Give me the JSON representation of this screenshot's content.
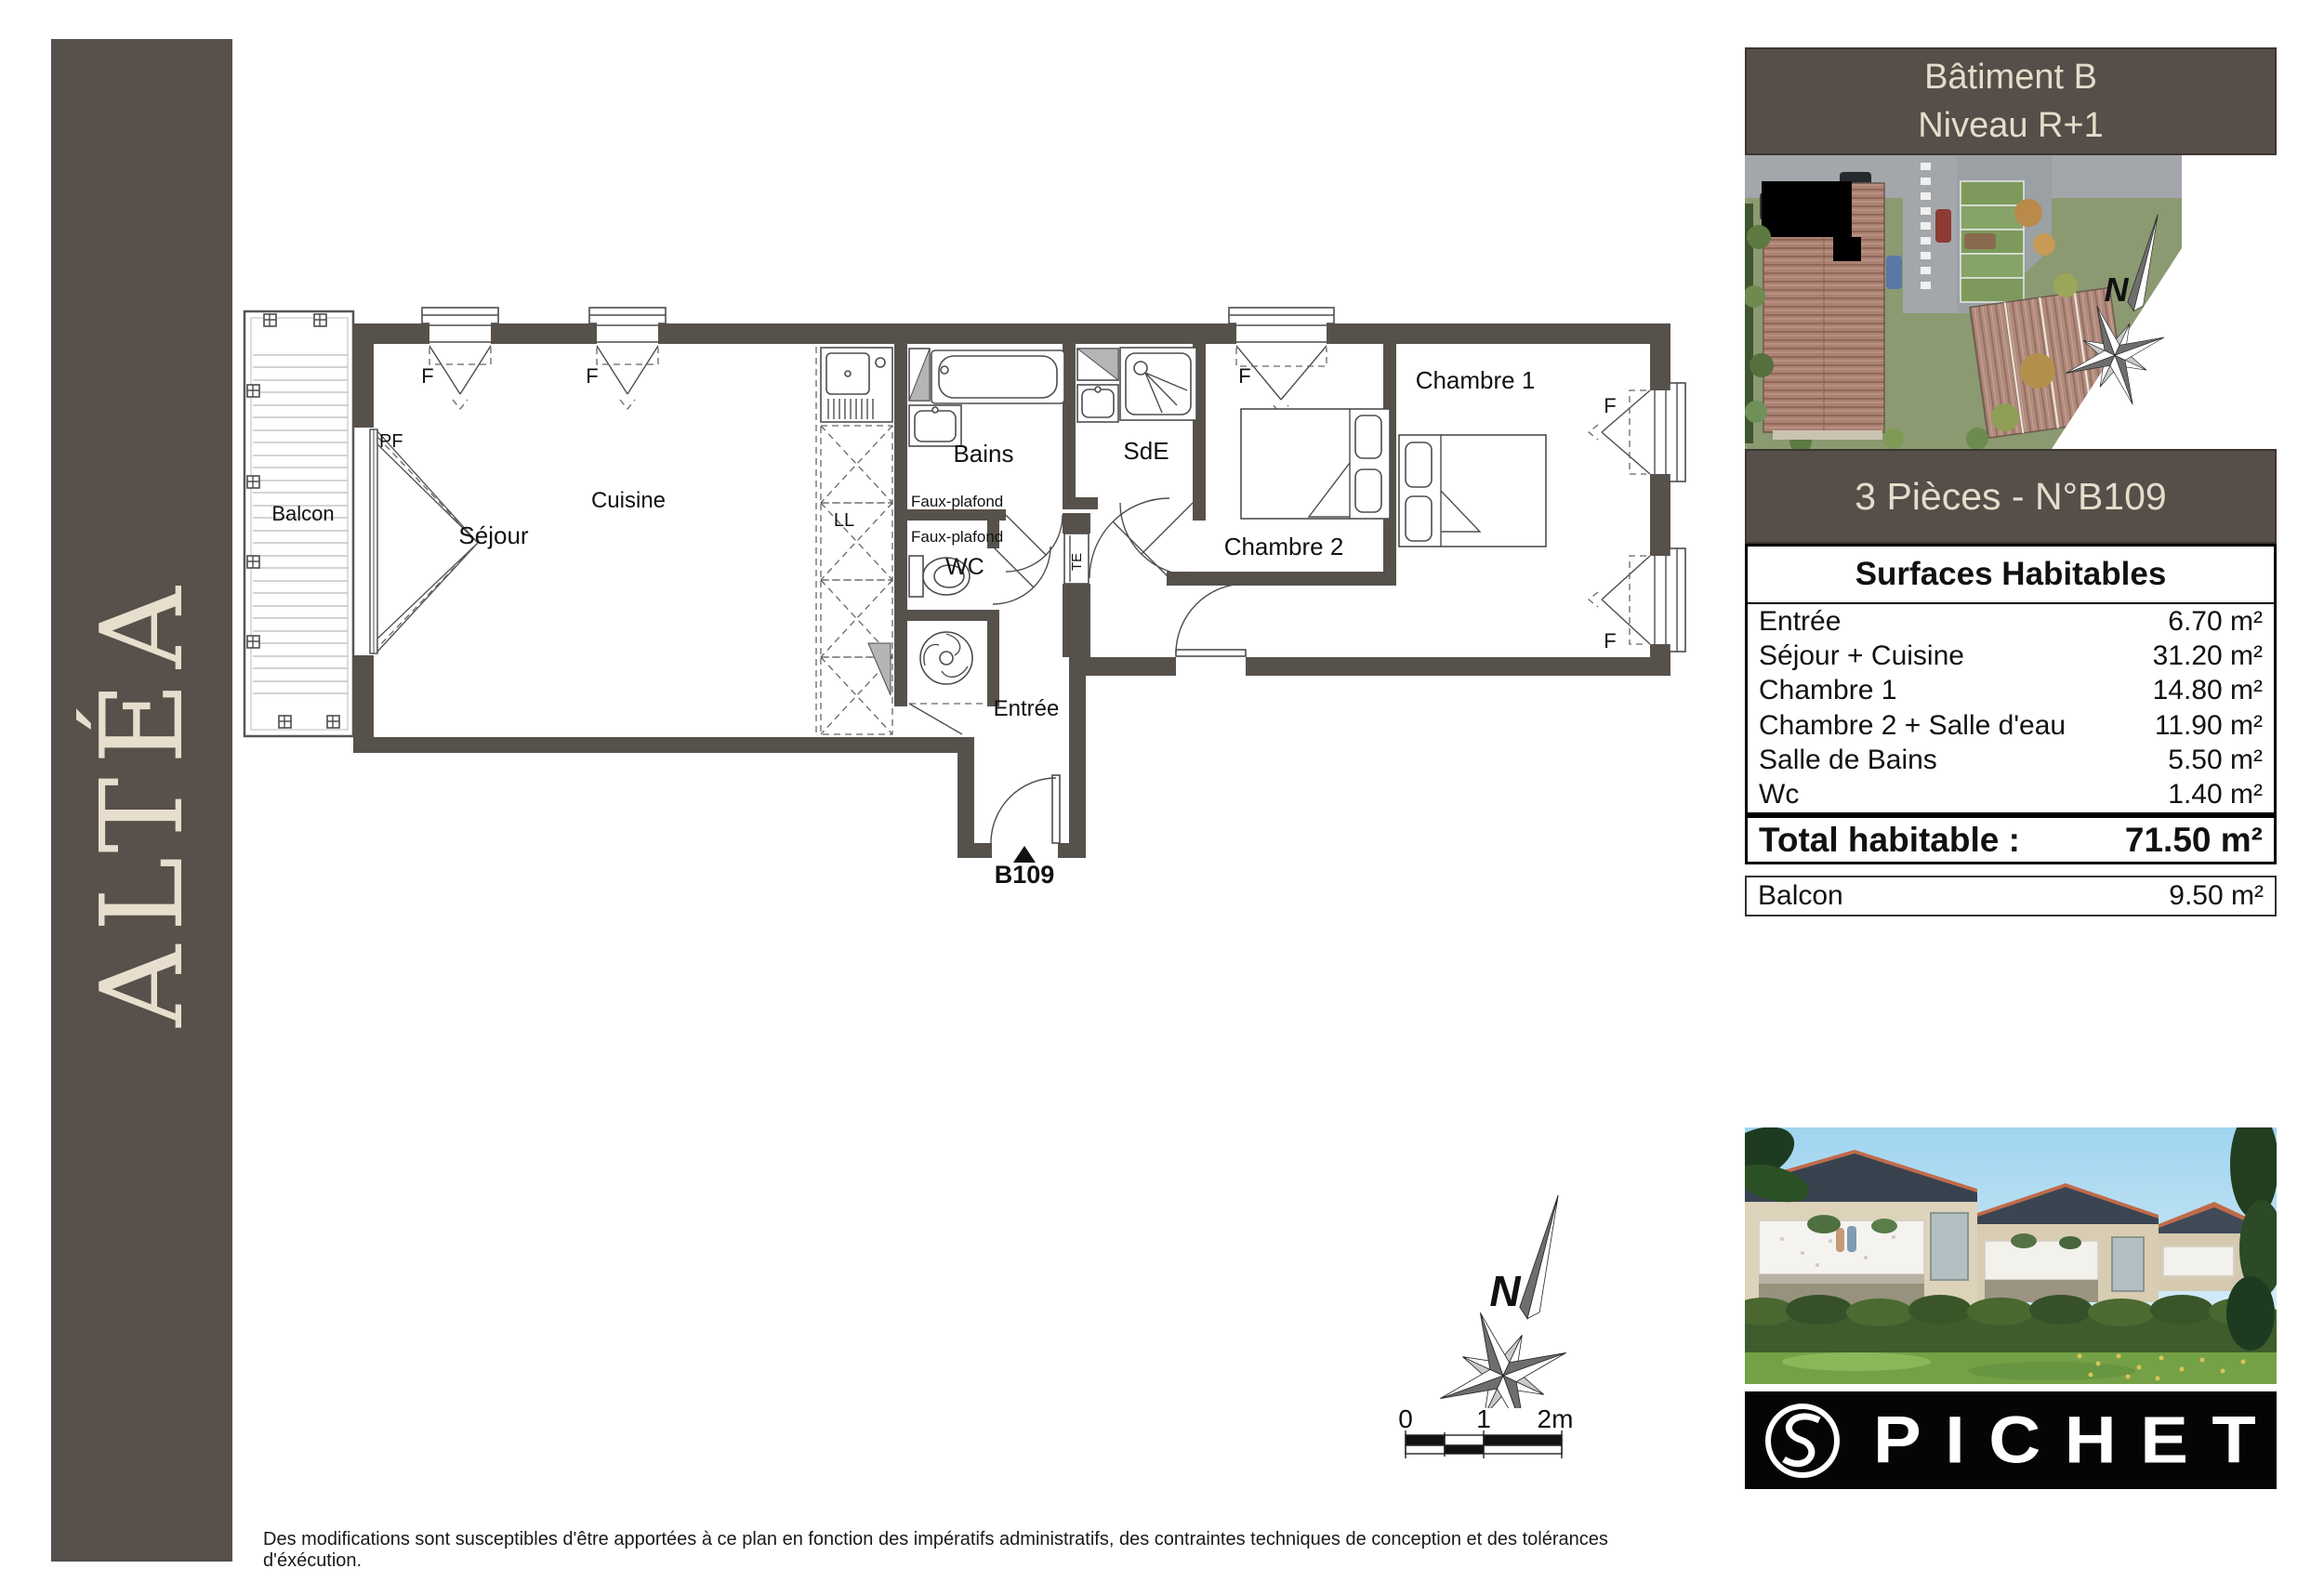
{
  "sidebar": {
    "brand": "ALTÉA"
  },
  "info_panel": {
    "building": "Bâtiment B",
    "level": "Niveau R+1",
    "unit_title": "3 Pièces - N°B109"
  },
  "surfaces": {
    "title": "Surfaces Habitables",
    "rows": [
      {
        "label": "Entrée",
        "value": "6.70 m²"
      },
      {
        "label": "Séjour + Cuisine",
        "value": "31.20 m²"
      },
      {
        "label": "Chambre 1",
        "value": "14.80 m²"
      },
      {
        "label": "Chambre 2 + Salle d'eau",
        "value": "11.90 m²"
      },
      {
        "label": "Salle de Bains",
        "value": "5.50 m²"
      },
      {
        "label": "Wc",
        "value": "1.40 m²"
      }
    ],
    "total_label": "Total habitable :",
    "total_value": "71.50 m²",
    "balcony_label": "Balcon",
    "balcony_value": "9.50 m²"
  },
  "plan": {
    "rooms": {
      "balcony": "Balcon",
      "living": "Séjour",
      "kitchen": "Cuisine",
      "bath": "Bains",
      "shower_room": "SdE",
      "wc": "WC",
      "bedroom1": "Chambre 1",
      "bedroom2": "Chambre 2",
      "entry": "Entrée"
    },
    "labels": {
      "window": "F",
      "french_door": "PF",
      "washer": "LL",
      "elec": "TE",
      "false_ceiling": "Faux-plafond",
      "unit": "B109"
    }
  },
  "compass": {
    "north": "N"
  },
  "scale_bar": {
    "t0": "0",
    "t1": "1",
    "t2": "2m"
  },
  "brand_logo": {
    "name": "PICHET"
  },
  "footer": {
    "disclaimer": "Des modifications sont susceptibles d'être apportées à ce plan en fonction des impératifs administratifs, des contraintes techniques de conception et des tolérances d'éxécution."
  },
  "colors": {
    "wall": "#57514C",
    "panel": "#554E49",
    "panel_text": "#E5DCCB",
    "logo_bg": "#050505"
  }
}
